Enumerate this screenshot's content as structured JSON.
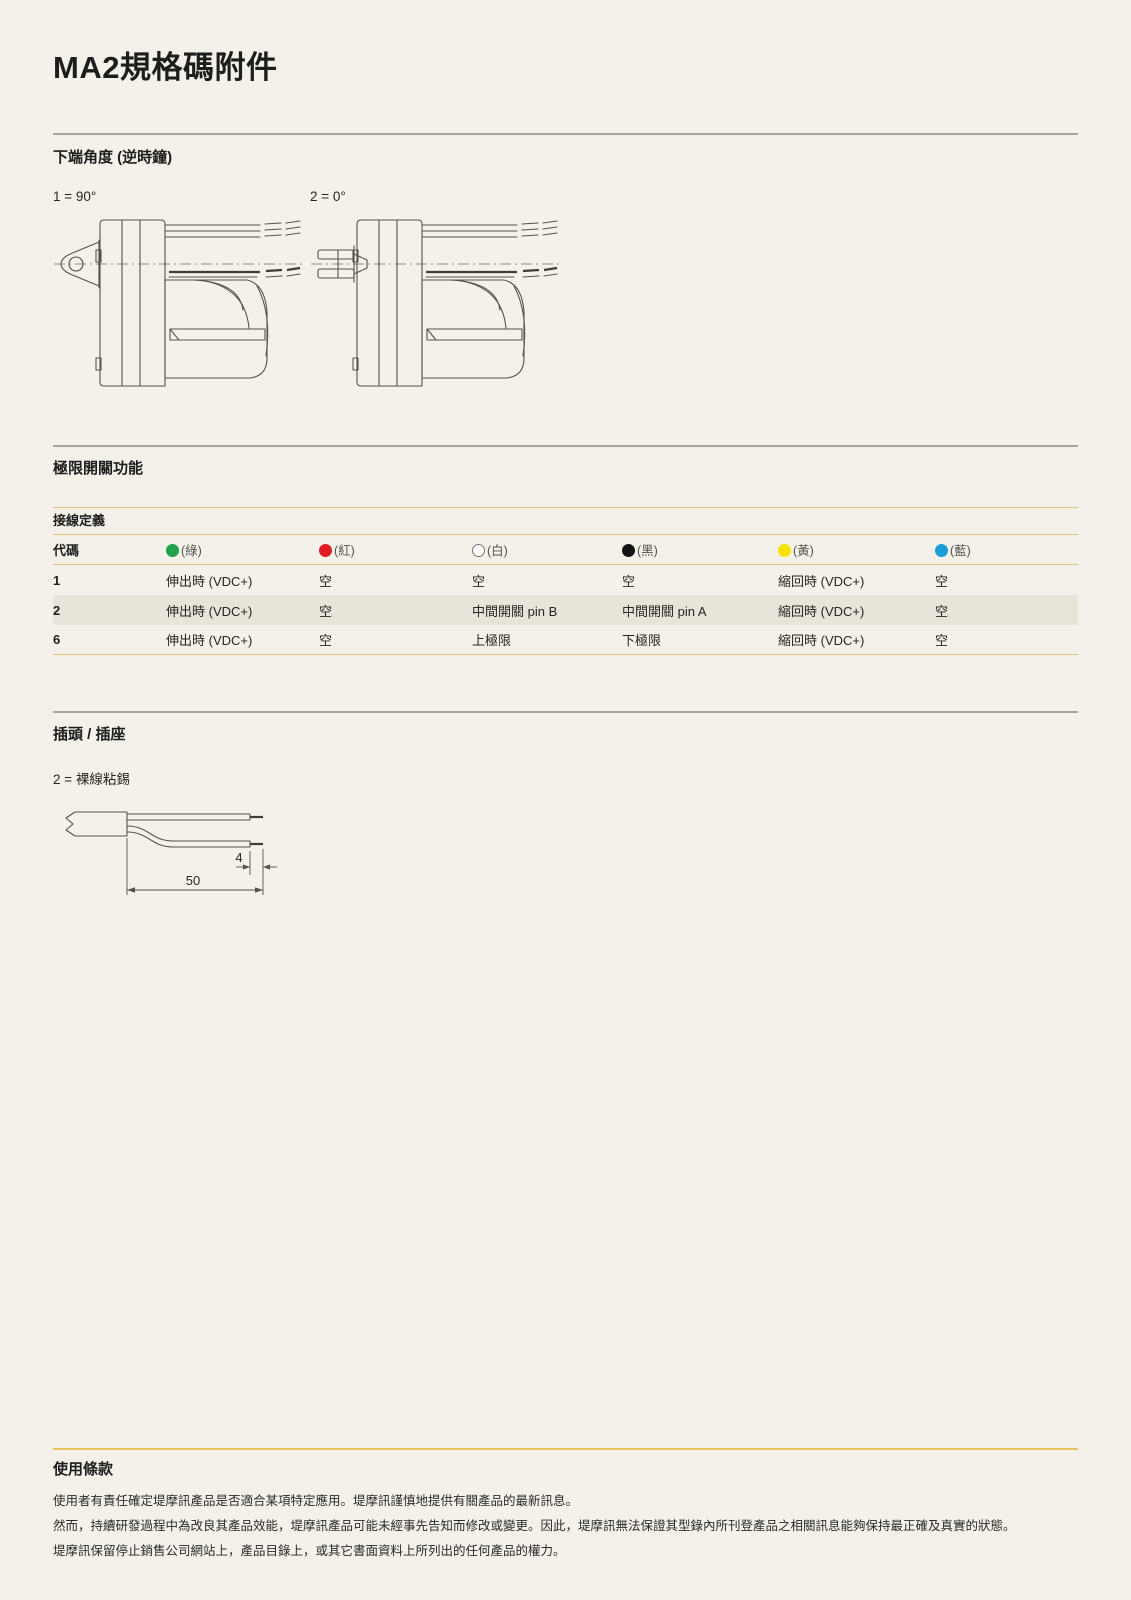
{
  "page": {
    "title": "MA2規格碼附件"
  },
  "bottom_angle": {
    "heading": "下端角度 (逆時鐘)",
    "options": [
      {
        "label": "1 = 90°"
      },
      {
        "label": "2 = 0°"
      }
    ]
  },
  "limit_switch": {
    "heading": "極限開關功能",
    "table": {
      "subheading": "接線定義",
      "code_header": "代碼",
      "wire_headers": [
        {
          "label": "(綠)",
          "color": "#21a24c",
          "border": "#21a24c"
        },
        {
          "label": "(紅)",
          "color": "#e01b24",
          "border": "#e01b24"
        },
        {
          "label": "(白)",
          "color": "#ffffff",
          "border": "#77756e"
        },
        {
          "label": "(黑)",
          "color": "#141414",
          "border": "#141414"
        },
        {
          "label": "(黃)",
          "color": "#f6e400",
          "border": "#f6e400"
        },
        {
          "label": "(藍)",
          "color": "#1b9cd9",
          "border": "#1b9cd9"
        }
      ],
      "rows": [
        {
          "code": "1",
          "shaded": false,
          "cells": [
            "伸出時 (VDC+)",
            "空",
            "空",
            "空",
            "縮回時 (VDC+)",
            "空"
          ]
        },
        {
          "code": "2",
          "shaded": true,
          "cells": [
            "伸出時 (VDC+)",
            "空",
            "中間開關 pin B",
            "中間開關 pin A",
            "縮回時 (VDC+)",
            "空"
          ]
        },
        {
          "code": "6",
          "shaded": false,
          "cells": [
            "伸出時 (VDC+)",
            "空",
            "上極限",
            "下極限",
            "縮回時 (VDC+)",
            "空"
          ]
        }
      ]
    }
  },
  "plug": {
    "heading": "插頭 / 插座",
    "option_label": "2 = 裸線粘錫",
    "dims": {
      "tip": "4",
      "total": "50"
    }
  },
  "terms": {
    "heading": "使用條款",
    "paragraphs": [
      "使用者有責任確定堤摩訊產品是否適合某項特定應用。堤摩訊謹慎地提供有關產品的最新訊息。",
      "然而，持續研發過程中為改良其產品效能，堤摩訊產品可能未經事先告知而修改或變更。因此，堤摩訊無法保證其型錄內所刊登產品之相關訊息能夠保持最正確及真實的狀態。",
      "堤摩訊保留停止銷售公司網站上，產品目錄上，或其它書面資料上所列出的任何產品的權力。"
    ]
  },
  "colors": {
    "background": "#f4f1ea",
    "divider_gray": "#a9a59c",
    "divider_gold": "#ecc363",
    "row_shade": "#e8e4da"
  }
}
